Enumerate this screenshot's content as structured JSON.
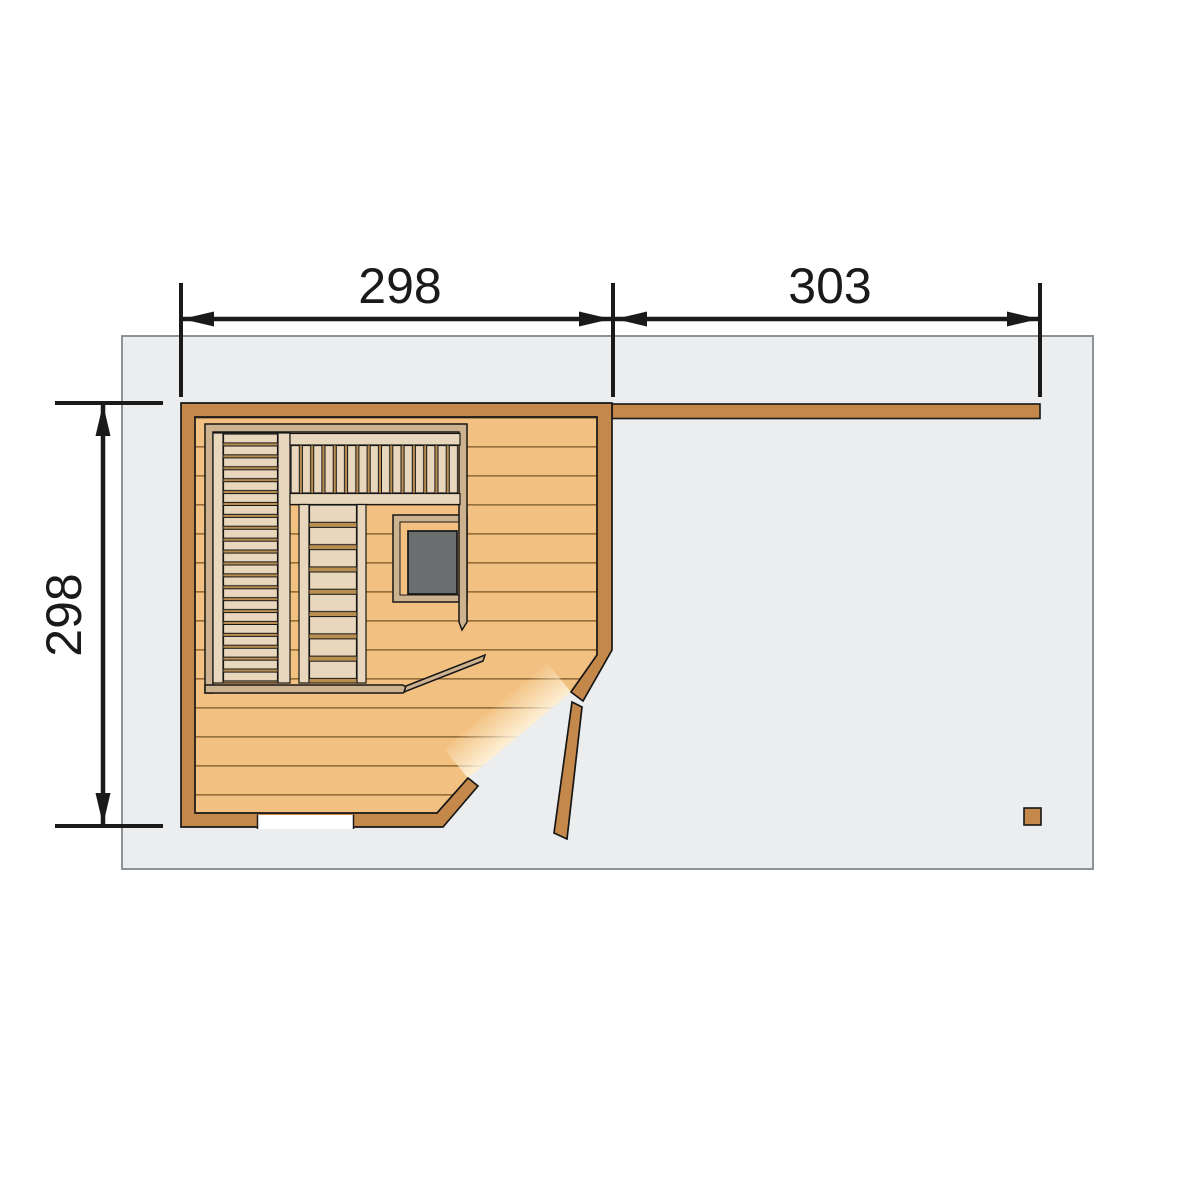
{
  "drawing": {
    "type": "sauna-floor-plan-top-view",
    "dimensions": {
      "top_left_label": "298",
      "top_right_label": "303",
      "left_label": "298"
    },
    "colors": {
      "wall_wood": "#c5884b",
      "floor_wood": "#f2c181",
      "plank_line": "#8a6331",
      "bench_wood": "#e8d7bd",
      "bench_gap": "#b98e51",
      "frame_wood": "#cdb290",
      "stove_gray": "#6c6d6f",
      "outline": "#161616",
      "dim_line": "#1a1a1a",
      "deck_fill": "#ebedee",
      "deck_border": "#8f9295",
      "window_white": "#ffffff"
    }
  }
}
